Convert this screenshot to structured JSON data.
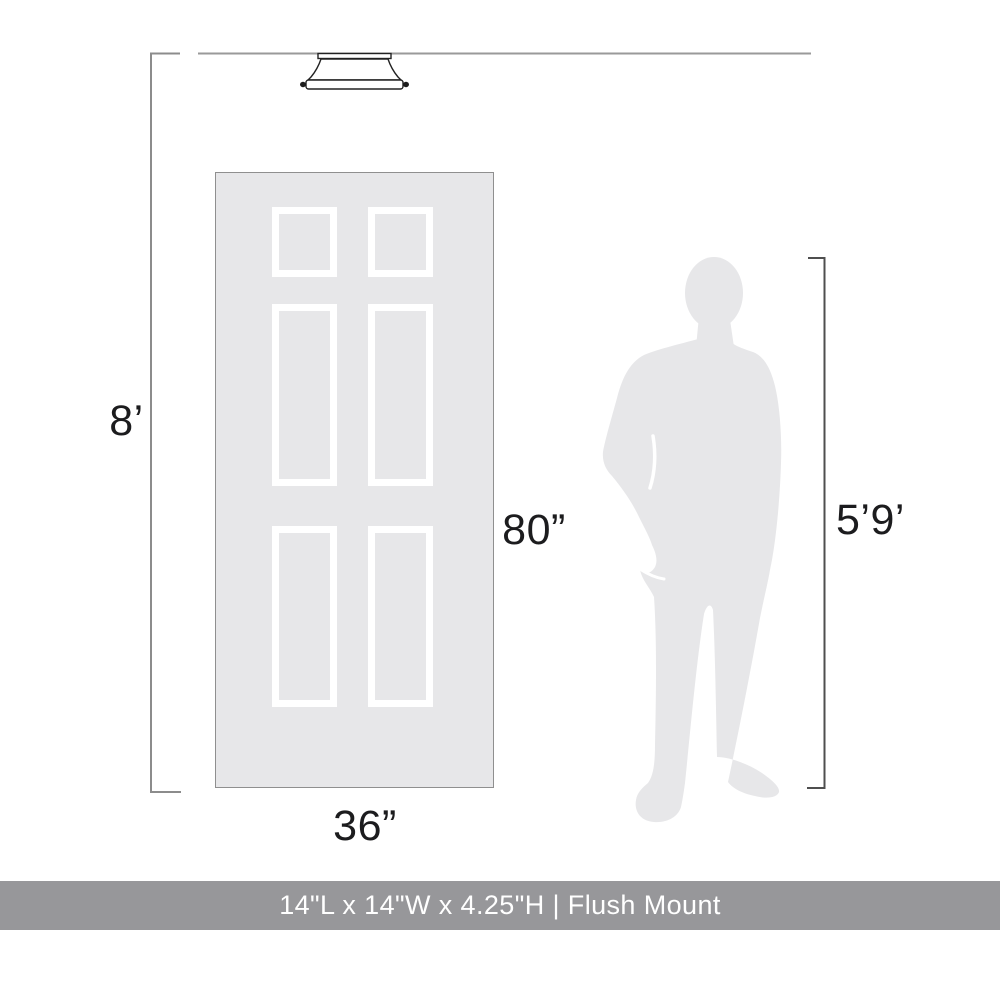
{
  "labels": {
    "ceiling_height": "8’",
    "door_height": "80”",
    "door_width": "36”",
    "person_height": "5’9’"
  },
  "footer": {
    "text": "14\"L x 14\"W x 4.25\"H | Flush Mount"
  },
  "scene": {
    "fixture": "flush-mount-ceiling-light",
    "reference_objects": [
      "door-36x80",
      "person-silhouette-5ft9"
    ]
  },
  "colors": {
    "background": "#ffffff",
    "door_fill": "#e7e7e9",
    "panel_frame": "#ffffff",
    "door_border": "#8f8f8f",
    "silhouette": "#e7e7e9",
    "ceiling_line": "#9a9a9a",
    "bracket_left": "#8c8c8c",
    "bracket_right": "#4f4f4f",
    "fixture_outline": "#222222",
    "label_text": "#1c1c1e",
    "footer_background": "#97979a",
    "footer_text": "#ffffff"
  }
}
